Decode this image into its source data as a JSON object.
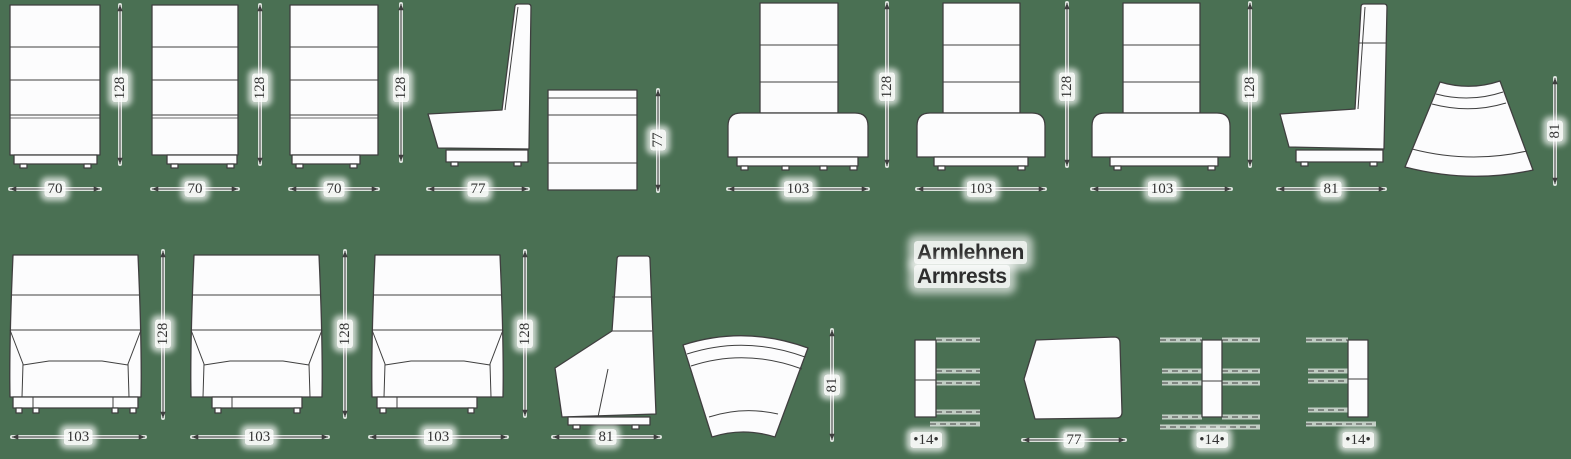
{
  "colors": {
    "background": "#4a7053",
    "line": "#3f3f3f",
    "text": "#333333",
    "shape_fill": "#fcfcfd",
    "halo": "#ffffff"
  },
  "heading": {
    "de": "Armlehnen",
    "en": "Armrests"
  },
  "figures": [
    {
      "name": "high-back-unit-front-70-a",
      "width": "70",
      "height": "128"
    },
    {
      "name": "high-back-unit-front-70-b",
      "width": "70",
      "height": "128"
    },
    {
      "name": "high-back-unit-front-70-c",
      "width": "70",
      "height": "128"
    },
    {
      "name": "high-back-unit-side-77",
      "width": "77"
    },
    {
      "name": "bench-side-77",
      "height": "77"
    },
    {
      "name": "high-back-unit-front-103-a",
      "width": "103",
      "height": "128"
    },
    {
      "name": "high-back-unit-front-103-b",
      "width": "103",
      "height": "128"
    },
    {
      "name": "high-back-unit-front-103-c",
      "width": "103",
      "height": "128"
    },
    {
      "name": "high-back-unit-side-81",
      "width": "81"
    },
    {
      "name": "curved-unit-top-view-a",
      "height": "81"
    },
    {
      "name": "tall-armchair-front-103-a",
      "width": "103",
      "height": "128"
    },
    {
      "name": "tall-armchair-front-103-b",
      "width": "103",
      "height": "128"
    },
    {
      "name": "tall-armchair-front-103-c",
      "width": "103",
      "height": "128"
    },
    {
      "name": "tall-armchair-side-81",
      "width": "81"
    },
    {
      "name": "curved-unit-top-view-b",
      "height": "81"
    },
    {
      "name": "armrest-front-a",
      "width": "•14•"
    },
    {
      "name": "armrest-side-77",
      "width": "77"
    },
    {
      "name": "armrest-front-b",
      "width": "•14•"
    },
    {
      "name": "armrest-front-c",
      "width": "•14•"
    }
  ]
}
